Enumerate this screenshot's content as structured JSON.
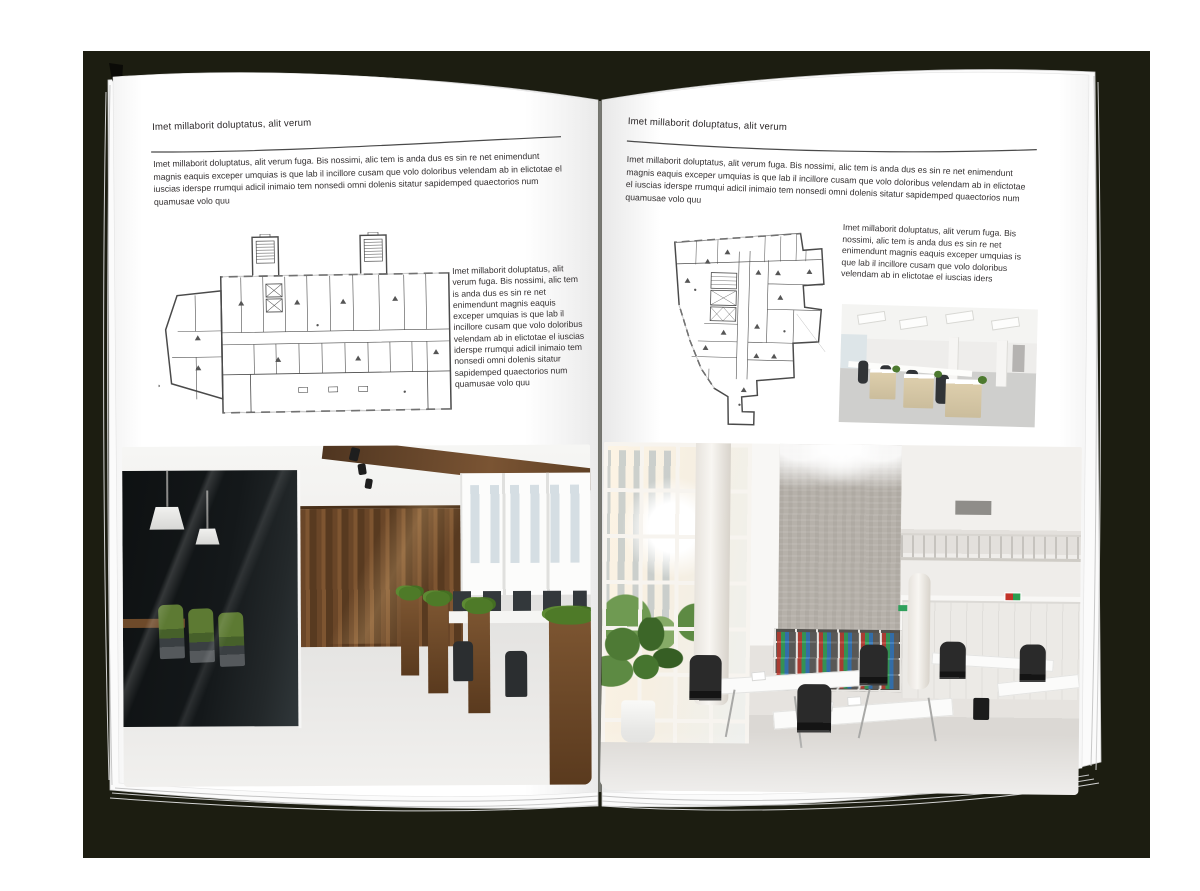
{
  "canvas": {
    "backdrop_color": "#1c1d11",
    "page_color": "#ffffff",
    "text_color": "#343031"
  },
  "left_page": {
    "header": "Imet millaborit doluptatus, alit verum",
    "intro": "Imet millaborit doluptatus, alit verum fuga. Bis nossimi, alic tem is anda dus es sin re net enimendunt magnis eaquis exceper umquias is que lab il incillore cusam que volo doloribus velendam ab in elictotae el iuscias iderspe rrumqui adicil inimaio tem nonsedi omni dolenis sitatur sapidemped quaectorios num quamusae volo quu",
    "side_text": "Imet millaborit doluptatus, alit verum fuga. Bis nossimi, alic tem is anda dus es sin re net enimendunt magnis eaquis exceper umquias is que lab il incillore cusam que volo doloribus velendam ab in elictotae el iuscias iderspe rrumqui adicil inimaio tem nonsedi omni dolenis sitatur sapidemped quaectorios num quamusae volo quu",
    "floor_plan": "wide rectangular office building floor plan with two stair towers and room grid",
    "photo": "modern office interior with dark glass meeting room, green chairs, wood-panel wall and wooden planters"
  },
  "right_page": {
    "header": "Imet millaborit doluptatus, alit verum",
    "intro": "Imet millaborit doluptatus, alit verum fuga. Bis nossimi, alic tem is anda dus es sin re net enimendunt magnis eaquis exceper umquias is que lab il incillore cusam que volo doloribus velendam ab in elictotae el iuscias iderspe rrumqui adicil inimaio tem nonsedi omni dolenis sitatur sapidemped quaectorios num quamusae volo quu",
    "side_text": "Imet millaborit doluptatus, alit verum fuga. Bis nossimi, alic tem is anda dus es sin re net enimendunt magnis eaquis exceper umquias is que lab il incillore cusam que volo doloribus velendam ab in elictotae el iuscias iders",
    "floor_plan": "irregular office building floor plan with angled left wall, elevator core and lower wing",
    "photo_small": "open-plan office with light wood cabinets, black task chairs and panel ceiling lights",
    "photo_large": "double-height white office hall with glazed wall, concrete feature wall, binder bookshelf and white desks"
  }
}
